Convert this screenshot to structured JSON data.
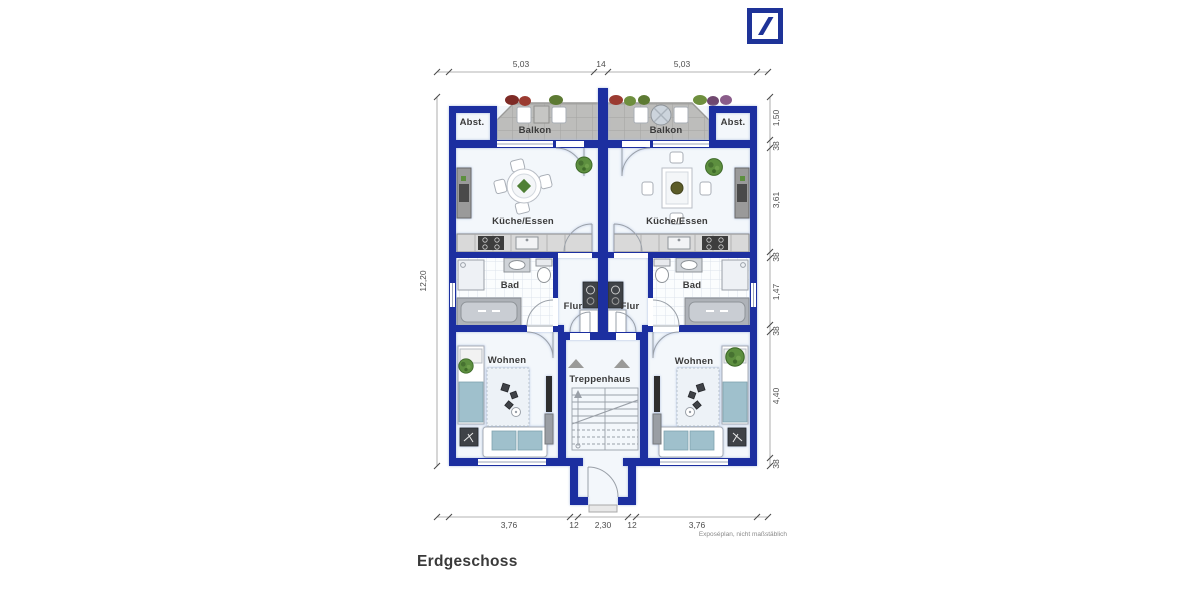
{
  "header": {
    "logo": {
      "name": "deutsche-bank-logo",
      "color": "#1E3398"
    }
  },
  "plan": {
    "rooms": {
      "abst_left": "Abst.",
      "balkon_left": "Balkon",
      "kueche_left": "Küche/Essen",
      "bad_left": "Bad",
      "flur_left": "Flur",
      "wohnen_left": "Wohnen",
      "treppenhaus": "Treppenhaus",
      "abst_right": "Abst.",
      "balkon_right": "Balkon",
      "kueche_right": "Küche/Essen",
      "bad_right": "Bad",
      "flur_right": "Flur",
      "wohnen_right": "Wohnen"
    },
    "dimensions": {
      "top": [
        "5,03",
        "14",
        "5,03"
      ],
      "right": [
        "1,50",
        "38",
        "3,61",
        "38",
        "1,47",
        "38",
        "4,40",
        "38"
      ],
      "left": "12,20",
      "bottom": [
        "3,76",
        "12",
        "2,30",
        "12",
        "3,76"
      ]
    },
    "colors": {
      "wall": "#1C2FA0",
      "room_fill": "#F3F7FB",
      "balcony_tile": "#BDBDBB",
      "sofa_teal": "#9FC0CC",
      "plant_green": "#5D8F3F",
      "dimension_text": "#4E4E4E"
    }
  },
  "footer": {
    "title": "Erdgeschoss",
    "footnote": "Exposéplan, nicht maßstäblich"
  }
}
